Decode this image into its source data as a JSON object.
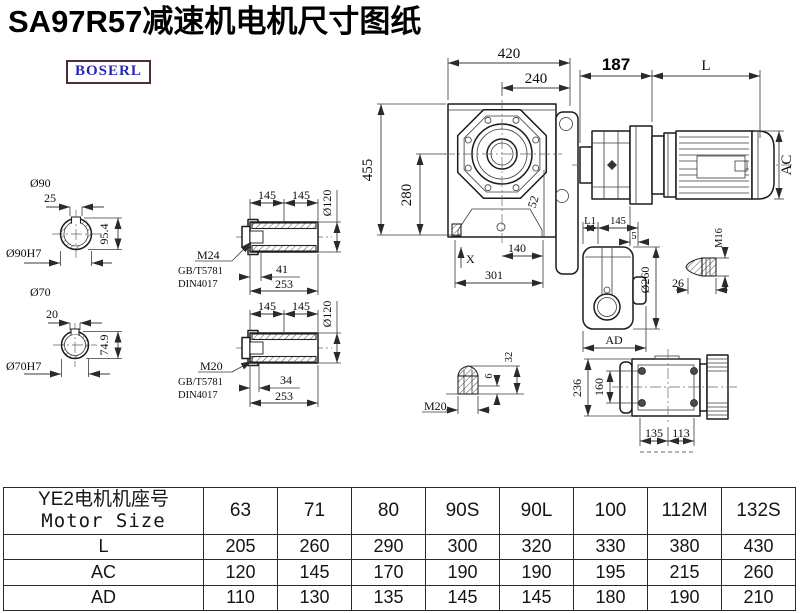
{
  "page": {
    "title": "SA97R57减速机电机尺寸图纸",
    "logo_text": "BOSERL",
    "colors": {
      "logo_text": "#2727b5",
      "logo_border": "#4a3030",
      "line": "#1c1c1c"
    }
  },
  "views": {
    "shaft90": {
      "diameter": "Ø90",
      "key_width": "25",
      "height": "95.4",
      "bore": "Ø90H7"
    },
    "shaft70": {
      "diameter": "Ø70",
      "key_width": "20",
      "height": "74.9",
      "bore": "Ø70H7"
    },
    "hollow_shaft_m24": {
      "seg1": "145",
      "seg2": "145",
      "dia": "Ø120",
      "thread": "M24",
      "std1": "GB/T5781",
      "std2": "DIN4017",
      "thread_len": "41",
      "total_len": "253"
    },
    "hollow_shaft_m20": {
      "seg1": "145",
      "seg2": "145",
      "dia": "Ø120",
      "thread": "M20",
      "std1": "GB/T5781",
      "std2": "DIN4017",
      "thread_len": "34",
      "total_len": "253"
    },
    "front_view": {
      "w420": "420",
      "w240": "240",
      "h455": "455",
      "h280": "280",
      "d52": "52",
      "x_mark": "X",
      "d140": "140",
      "d301": "301"
    },
    "motor_view": {
      "d187": "187",
      "len": "L",
      "dia": "AC"
    },
    "side_view": {
      "l1": "L1",
      "d145": "145",
      "d5": "5",
      "dia": "Ø260",
      "ad": "AD"
    },
    "plug_m16": {
      "thread": "M16",
      "d26": "26"
    },
    "plug_m20": {
      "thread": "M20",
      "d6": "6",
      "d32": "32"
    },
    "top_view": {
      "d236": "236",
      "d160": "160",
      "d135": "135",
      "d113": "113"
    }
  },
  "table": {
    "header_line1": "YE2电机机座号",
    "header_line2": "Motor Size",
    "sizes": [
      "63",
      "71",
      "80",
      "90S",
      "90L",
      "100",
      "112M",
      "132S"
    ],
    "rows": [
      {
        "label": "L",
        "values": [
          "205",
          "260",
          "290",
          "300",
          "320",
          "330",
          "380",
          "430"
        ]
      },
      {
        "label": "AC",
        "values": [
          "120",
          "145",
          "170",
          "190",
          "190",
          "195",
          "215",
          "260"
        ]
      },
      {
        "label": "AD",
        "values": [
          "110",
          "130",
          "135",
          "145",
          "145",
          "180",
          "190",
          "210"
        ]
      }
    ]
  }
}
